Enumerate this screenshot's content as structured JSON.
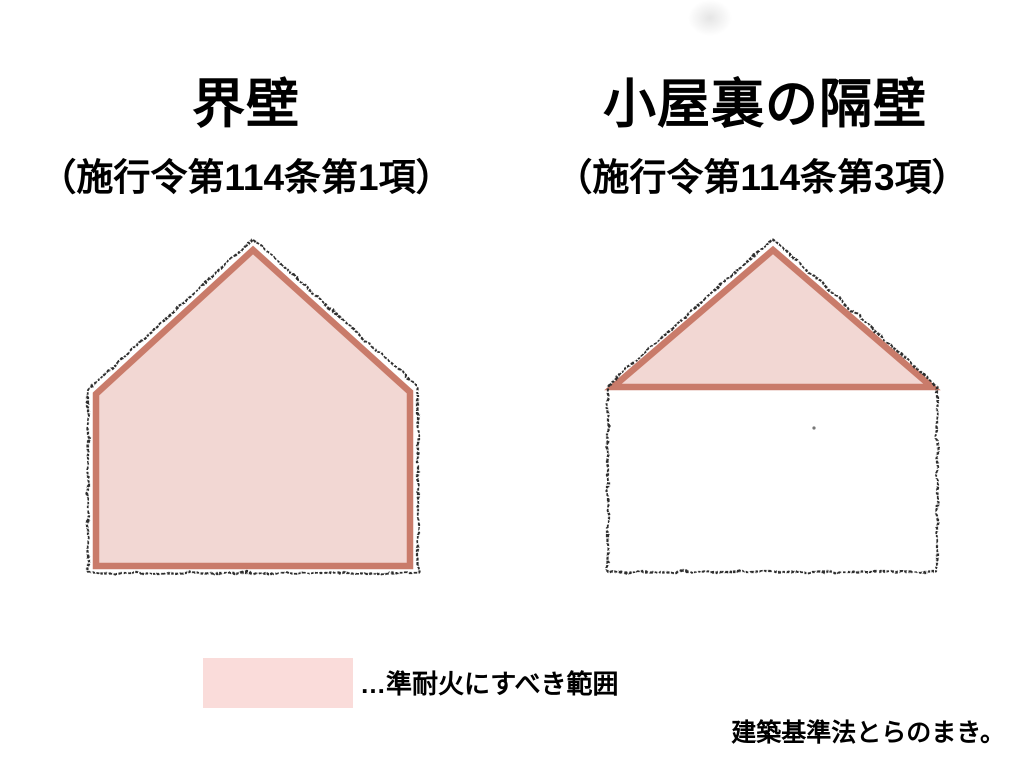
{
  "page": {
    "panels": [
      {
        "title": "界壁",
        "subtitle": "（施行令第114条第1項）"
      },
      {
        "title": "小屋裏の隔壁",
        "subtitle": "（施行令第114条第3項）"
      }
    ],
    "legend": {
      "label": "…準耐火にすべき範囲"
    },
    "credit": "建築基準法とらのまき。",
    "colors": {
      "shade_fill": "#f2d7d3",
      "shade_border": "#c97b6a",
      "legend_swatch": "#fadcda",
      "sketch_line": "#2d2d2d",
      "stray_dot": "#555555"
    }
  }
}
